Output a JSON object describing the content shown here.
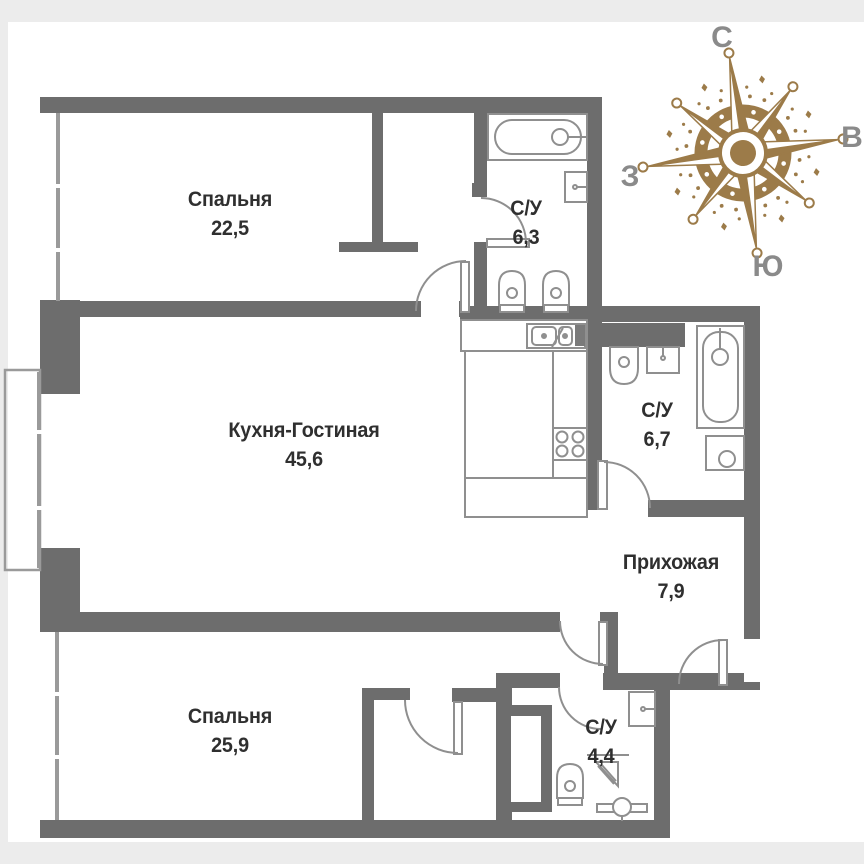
{
  "rooms": [
    {
      "name": "Спальня",
      "area": "22,5"
    },
    {
      "name": "С/У",
      "area": "6,3"
    },
    {
      "name": "Кухня-Гостиная",
      "area": "45,6"
    },
    {
      "name": "С/У",
      "area": "6,7"
    },
    {
      "name": "Прихожая",
      "area": "7,9"
    },
    {
      "name": "Спальня",
      "area": "25,9"
    },
    {
      "name": "С/У",
      "area": "4,4"
    }
  ],
  "compass": {
    "north": "С",
    "east": "В",
    "west": "З",
    "south": "Ю",
    "color": "#9c7b49",
    "label_color": "#8a8a8a"
  },
  "colors": {
    "wall": "#6d6d6d",
    "fixture_line": "#8f8f8f",
    "window_line": "#9a9a9a",
    "background": "#ececec",
    "canvas": "#ffffff",
    "text": "#2f2f2f"
  },
  "fixture_icons": [
    "bathtub-icon",
    "sink-icon",
    "toilet-icon",
    "bidet-icon",
    "kitchen-sink-icon",
    "stove-icon",
    "washing-machine-icon",
    "shower-corner-icon",
    "towel-dryer-icon",
    "duct-shaft",
    "compass-rose-icon"
  ]
}
